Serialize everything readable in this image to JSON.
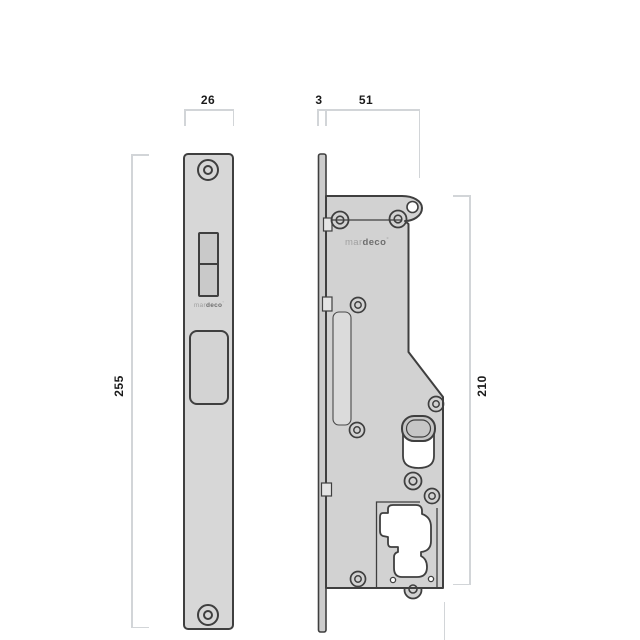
{
  "drawing": {
    "title": "mortice-lock-technical-drawing",
    "brand": {
      "prefix": "mar",
      "bold": "deco",
      "symbol": "°"
    },
    "dimensions": {
      "faceplate_width": "26",
      "faceplate_thickness": "3",
      "case_width": "51",
      "faceplate_height": "255",
      "case_height": "210"
    },
    "colors": {
      "outline": "#3f3f3f",
      "metal_fill": "#d2d2d2",
      "faceplate_fill": "#d7d7d7",
      "dimension_line": "#d2d5d8",
      "label_text": "#1a1a1a",
      "background": "#ffffff"
    }
  }
}
